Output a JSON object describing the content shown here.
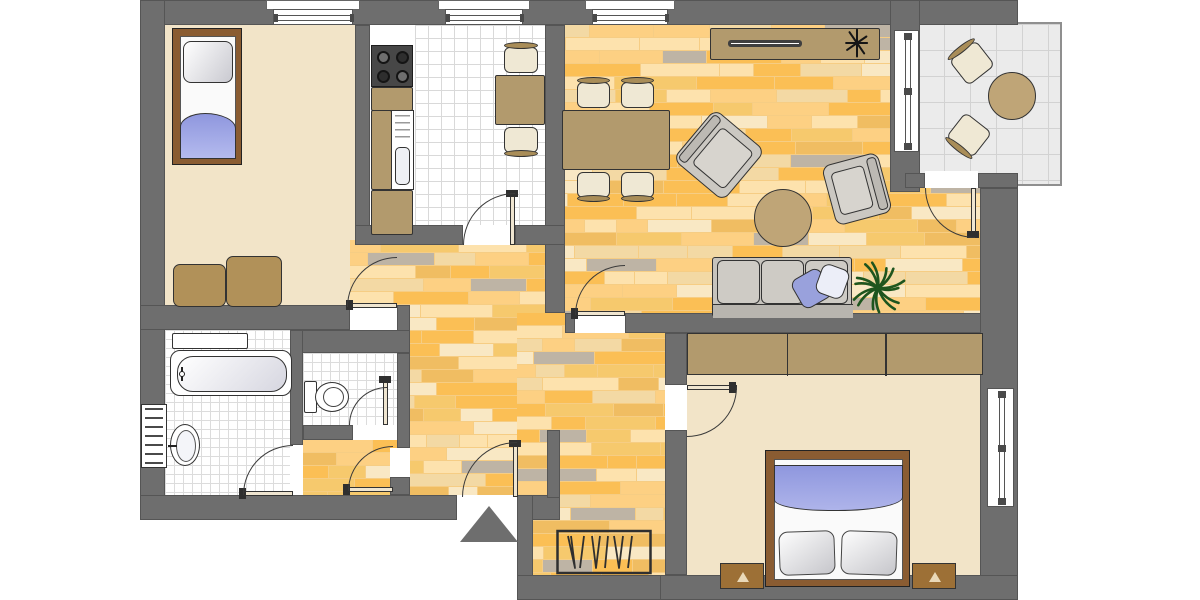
{
  "meta": {
    "type": "apartment-floor-plan",
    "canvas": [
      1200,
      600
    ]
  },
  "palette": {
    "wall": "#6e6e6e",
    "room_beige": "#f2e4c8",
    "wood_base": "#f6cd84",
    "wood_planks": [
      "#fdd083",
      "#fbbf55",
      "#fde2ad",
      "#f6c96d",
      "#f3d9a4",
      "#beb4a5",
      "#f9e8c4",
      "#f0bd62"
    ],
    "furniture_wood": "#b29a6d",
    "bed_frame": "#8a5c32",
    "blanket_blue": "#9299e0",
    "upholstery_gray": "#cbc8c2",
    "plant_green": "#1e551e",
    "tile_line": "#dcdcdc",
    "balcony_tile": "#ebebeb"
  },
  "rooms": [
    {
      "name": "bedroom-1",
      "floor": "beige",
      "rect": [
        165,
        25,
        190,
        282
      ]
    },
    {
      "name": "bedroom-1-extension",
      "floor": "beige",
      "rect": [
        350,
        245,
        50,
        62
      ]
    },
    {
      "name": "kitchen-counter-strip",
      "floor": "white",
      "rect": [
        370,
        25,
        45,
        200
      ]
    },
    {
      "name": "kitchen",
      "floor": "tiles-k",
      "rect": [
        415,
        25,
        130,
        200
      ]
    },
    {
      "name": "living-room",
      "floor": "wood",
      "rect": [
        565,
        25,
        420,
        288
      ]
    },
    {
      "name": "hallway",
      "floor": "wood",
      "rect": [
        350,
        240,
        215,
        260
      ]
    },
    {
      "name": "hallway-bath-corridor",
      "floor": "wood",
      "rect": [
        303,
        440,
        95,
        55
      ]
    },
    {
      "name": "hallway-south-and-storage",
      "floor": "wood",
      "rect": [
        517,
        313,
        170,
        262
      ]
    },
    {
      "name": "bathroom",
      "floor": "tiles-s",
      "rect": [
        165,
        330,
        127,
        165
      ]
    },
    {
      "name": "wc",
      "floor": "tiles-s",
      "rect": [
        303,
        353,
        94,
        72
      ]
    },
    {
      "name": "bedroom-2",
      "floor": "beige",
      "rect": [
        687,
        333,
        298,
        242
      ]
    },
    {
      "name": "balcony",
      "floor": "tiles-b",
      "rect": [
        916,
        22,
        146,
        164
      ]
    }
  ],
  "walls": [
    [
      140,
      0,
      878,
      25
    ],
    [
      140,
      0,
      25,
      520
    ],
    [
      355,
      25,
      15,
      220
    ],
    [
      545,
      25,
      20,
      288
    ],
    [
      355,
      225,
      108,
      20
    ],
    [
      515,
      225,
      50,
      20
    ],
    [
      565,
      313,
      10,
      20
    ],
    [
      625,
      313,
      360,
      20
    ],
    [
      890,
      0,
      30,
      192
    ],
    [
      905,
      173,
      20,
      15
    ],
    [
      978,
      173,
      40,
      15
    ],
    [
      980,
      188,
      38,
      412
    ],
    [
      140,
      305,
      210,
      25
    ],
    [
      397,
      305,
      13,
      48
    ],
    [
      290,
      330,
      120,
      23
    ],
    [
      290,
      330,
      13,
      115
    ],
    [
      397,
      353,
      13,
      95
    ],
    [
      303,
      425,
      50,
      15
    ],
    [
      390,
      477,
      20,
      18
    ],
    [
      140,
      495,
      317,
      25
    ],
    [
      517,
      495,
      43,
      25
    ],
    [
      517,
      495,
      16,
      105
    ],
    [
      547,
      430,
      13,
      68
    ],
    [
      517,
      575,
      170,
      25
    ],
    [
      660,
      575,
      358,
      25
    ],
    [
      665,
      333,
      22,
      52
    ],
    [
      665,
      430,
      22,
      145
    ]
  ],
  "doorways": [
    [
      350,
      305,
      47,
      25
    ],
    [
      463,
      225,
      52,
      20
    ],
    [
      575,
      313,
      50,
      20
    ],
    [
      925,
      171,
      53,
      17
    ],
    [
      665,
      385,
      22,
      45
    ],
    [
      290,
      445,
      13,
      50
    ],
    [
      353,
      425,
      44,
      15
    ],
    [
      390,
      448,
      20,
      29
    ],
    [
      457,
      495,
      60,
      25
    ]
  ],
  "windows": [
    {
      "name": "bedroom1-window",
      "orient": "h",
      "rect": [
        273,
        9,
        80,
        16
      ],
      "sill": [
        266,
        0,
        94,
        10
      ]
    },
    {
      "name": "kitchen-window",
      "orient": "h",
      "rect": [
        445,
        9,
        78,
        16
      ],
      "sill": [
        438,
        0,
        92,
        10
      ]
    },
    {
      "name": "living-room-window",
      "orient": "h",
      "rect": [
        592,
        9,
        76,
        16
      ],
      "sill": [
        585,
        0,
        90,
        10
      ]
    },
    {
      "name": "balcony-window",
      "orient": "v",
      "rect": [
        894,
        30,
        25,
        122
      ]
    },
    {
      "name": "bedroom2-window",
      "orient": "v",
      "rect": [
        987,
        388,
        27,
        119
      ]
    }
  ],
  "doors": [
    {
      "name": "bedroom1-door",
      "leaf": [
        350,
        303,
        47,
        5
      ],
      "handle": [
        346,
        300,
        7,
        10
      ],
      "arc": [
        347,
        257,
        50,
        50
      ],
      "corner": "tl"
    },
    {
      "name": "kitchen-door",
      "leaf": [
        510,
        193,
        5,
        52
      ],
      "handle": [
        506,
        190,
        12,
        7
      ],
      "arc": [
        463,
        193,
        52,
        52
      ],
      "corner": "tl"
    },
    {
      "name": "living-room-door",
      "leaf": [
        575,
        311,
        50,
        5
      ],
      "handle": [
        571,
        308,
        7,
        11
      ],
      "arc": [
        575,
        265,
        50,
        50
      ],
      "corner": "tl"
    },
    {
      "name": "balcony-door",
      "leaf": [
        971,
        188,
        5,
        50
      ],
      "handle": [
        967,
        231,
        12,
        7
      ],
      "arc": [
        925,
        188,
        50,
        50
      ],
      "corner": "bl"
    },
    {
      "name": "bedroom2-door",
      "leaf": [
        687,
        385,
        50,
        5
      ],
      "handle": [
        729,
        382,
        7,
        11
      ],
      "arc": [
        687,
        387,
        50,
        50
      ],
      "corner": "br"
    },
    {
      "name": "bathroom-door",
      "leaf": [
        243,
        491,
        50,
        5
      ],
      "handle": [
        239,
        488,
        7,
        11
      ],
      "arc": [
        243,
        445,
        50,
        50
      ],
      "corner": "tl"
    },
    {
      "name": "wc-door",
      "leaf": [
        383,
        379,
        5,
        46
      ],
      "handle": [
        379,
        376,
        12,
        7
      ],
      "arc": [
        349,
        387,
        38,
        38
      ],
      "corner": "tl"
    },
    {
      "name": "hall-corridor-door",
      "leaf": [
        347,
        487,
        46,
        5
      ],
      "handle": [
        343,
        484,
        7,
        11
      ],
      "arc": [
        348,
        446,
        45,
        45
      ],
      "corner": "tl"
    },
    {
      "name": "entrance-door",
      "leaf": [
        513,
        443,
        5,
        54
      ],
      "handle": [
        509,
        440,
        12,
        7
      ],
      "arc": [
        462,
        442,
        55,
        55
      ],
      "corner": "tl"
    }
  ],
  "furniture": [
    {
      "t": "bed-single",
      "name": "single-bed",
      "rect": [
        172,
        28,
        70,
        137
      ]
    },
    {
      "t": "box",
      "name": "bench-cushion",
      "rect": [
        173,
        264,
        53,
        43
      ],
      "bg": "#b19159",
      "radius": 7
    },
    {
      "t": "box",
      "name": "bench-cushion",
      "rect": [
        226,
        256,
        56,
        51
      ],
      "bg": "#b19159",
      "radius": 7
    },
    {
      "t": "stove",
      "name": "stove",
      "rect": [
        371,
        45,
        42,
        42
      ]
    },
    {
      "t": "box",
      "name": "kitchen-cabinet",
      "rect": [
        371,
        87,
        42,
        24
      ],
      "bg": "#b29a6d"
    },
    {
      "t": "box",
      "name": "kitchen-cabinet",
      "rect": [
        371,
        110,
        21,
        80
      ],
      "bg": "#b29a6d"
    },
    {
      "t": "sink",
      "name": "kitchen-sink",
      "rect": [
        391,
        110,
        23,
        80
      ]
    },
    {
      "t": "box",
      "name": "kitchen-cabinet",
      "rect": [
        371,
        190,
        42,
        45
      ],
      "bg": "#b29a6d"
    },
    {
      "t": "box",
      "name": "kitchen-table",
      "rect": [
        495,
        75,
        50,
        50
      ],
      "bg": "#b29a6d"
    },
    {
      "t": "chair",
      "name": "kitchen-chair",
      "rect": [
        502,
        44,
        38,
        32
      ],
      "back": "top",
      "rot": 0
    },
    {
      "t": "chair",
      "name": "kitchen-chair",
      "rect": [
        502,
        124,
        38,
        32
      ],
      "back": "bottom",
      "rot": 0
    },
    {
      "t": "box",
      "name": "sideboard",
      "rect": [
        710,
        28,
        170,
        32
      ],
      "bg": "#b29a6d"
    },
    {
      "t": "slot",
      "name": "sideboard-groove",
      "rect": [
        728,
        40,
        74,
        7
      ]
    },
    {
      "t": "star",
      "name": "decor-plant",
      "rect": [
        842,
        28,
        30,
        30
      ]
    },
    {
      "t": "box",
      "name": "dining-table",
      "rect": [
        562,
        110,
        108,
        60
      ],
      "bg": "#b29a6d"
    },
    {
      "t": "chair",
      "name": "dining-chair",
      "rect": [
        575,
        79,
        37,
        32
      ],
      "back": "top",
      "rot": 0
    },
    {
      "t": "chair",
      "name": "dining-chair",
      "rect": [
        619,
        79,
        37,
        32
      ],
      "back": "top",
      "rot": 0
    },
    {
      "t": "chair",
      "name": "dining-chair",
      "rect": [
        575,
        169,
        37,
        32
      ],
      "back": "bottom",
      "rot": 0
    },
    {
      "t": "chair",
      "name": "dining-chair",
      "rect": [
        619,
        169,
        37,
        32
      ],
      "back": "bottom",
      "rot": 0
    },
    {
      "t": "armchair",
      "name": "armchair",
      "rect": [
        686,
        122,
        66,
        66
      ],
      "back": "left",
      "rot": 40
    },
    {
      "t": "armchair",
      "name": "armchair",
      "rect": [
        828,
        158,
        58,
        62
      ],
      "back": "right",
      "rot": -15
    },
    {
      "t": "round",
      "name": "coffee-table",
      "rect": [
        754,
        189,
        58,
        58
      ]
    },
    {
      "t": "sofa",
      "name": "sofa",
      "rect": [
        712,
        257,
        140,
        60
      ]
    },
    {
      "t": "pillow",
      "name": "sofa-pillow",
      "rect": [
        795,
        272,
        33,
        33
      ],
      "bg": "#99a1dc",
      "rot": -30
    },
    {
      "t": "pillow",
      "name": "sofa-pillow",
      "rect": [
        818,
        266,
        29,
        31
      ],
      "bg": "#eceef8",
      "rot": 20
    },
    {
      "t": "plant",
      "name": "palm-plant",
      "rect": [
        850,
        260,
        56,
        56
      ]
    },
    {
      "t": "chair",
      "name": "balcony-chair",
      "rect": [
        953,
        44,
        38,
        38
      ],
      "back": "top",
      "rot": -38
    },
    {
      "t": "chair",
      "name": "balcony-chair",
      "rect": [
        950,
        116,
        38,
        38
      ],
      "back": "bottom",
      "rot": 38
    },
    {
      "t": "round",
      "name": "balcony-table",
      "rect": [
        988,
        72,
        48,
        48
      ]
    },
    {
      "t": "box",
      "name": "bathroom-shelf",
      "rect": [
        172,
        333,
        76,
        16
      ],
      "bg": "#ffffff"
    },
    {
      "t": "tub",
      "name": "bathtub",
      "rect": [
        170,
        350,
        122,
        46
      ]
    },
    {
      "t": "basin",
      "name": "washbasin",
      "rect": [
        170,
        424,
        30,
        42
      ]
    },
    {
      "t": "radiator",
      "name": "radiator",
      "rect": [
        141,
        404,
        26,
        64
      ]
    },
    {
      "t": "toilet",
      "name": "toilet",
      "rect": [
        304,
        381,
        46,
        32
      ]
    },
    {
      "t": "tri",
      "name": "entrance-marker",
      "rect": [
        460,
        506,
        58,
        36
      ]
    },
    {
      "t": "rail",
      "name": "clothes-rail",
      "rect": [
        556,
        528,
        96,
        48
      ]
    },
    {
      "t": "wardrobe",
      "name": "wardrobe",
      "rect": [
        687,
        333,
        296,
        42
      ]
    },
    {
      "t": "bed-double",
      "name": "double-bed",
      "rect": [
        765,
        450,
        145,
        137
      ]
    },
    {
      "t": "nightstand",
      "name": "nightstand",
      "rect": [
        720,
        563,
        44,
        26
      ]
    },
    {
      "t": "nightstand",
      "name": "nightstand",
      "rect": [
        912,
        563,
        44,
        26
      ]
    }
  ]
}
